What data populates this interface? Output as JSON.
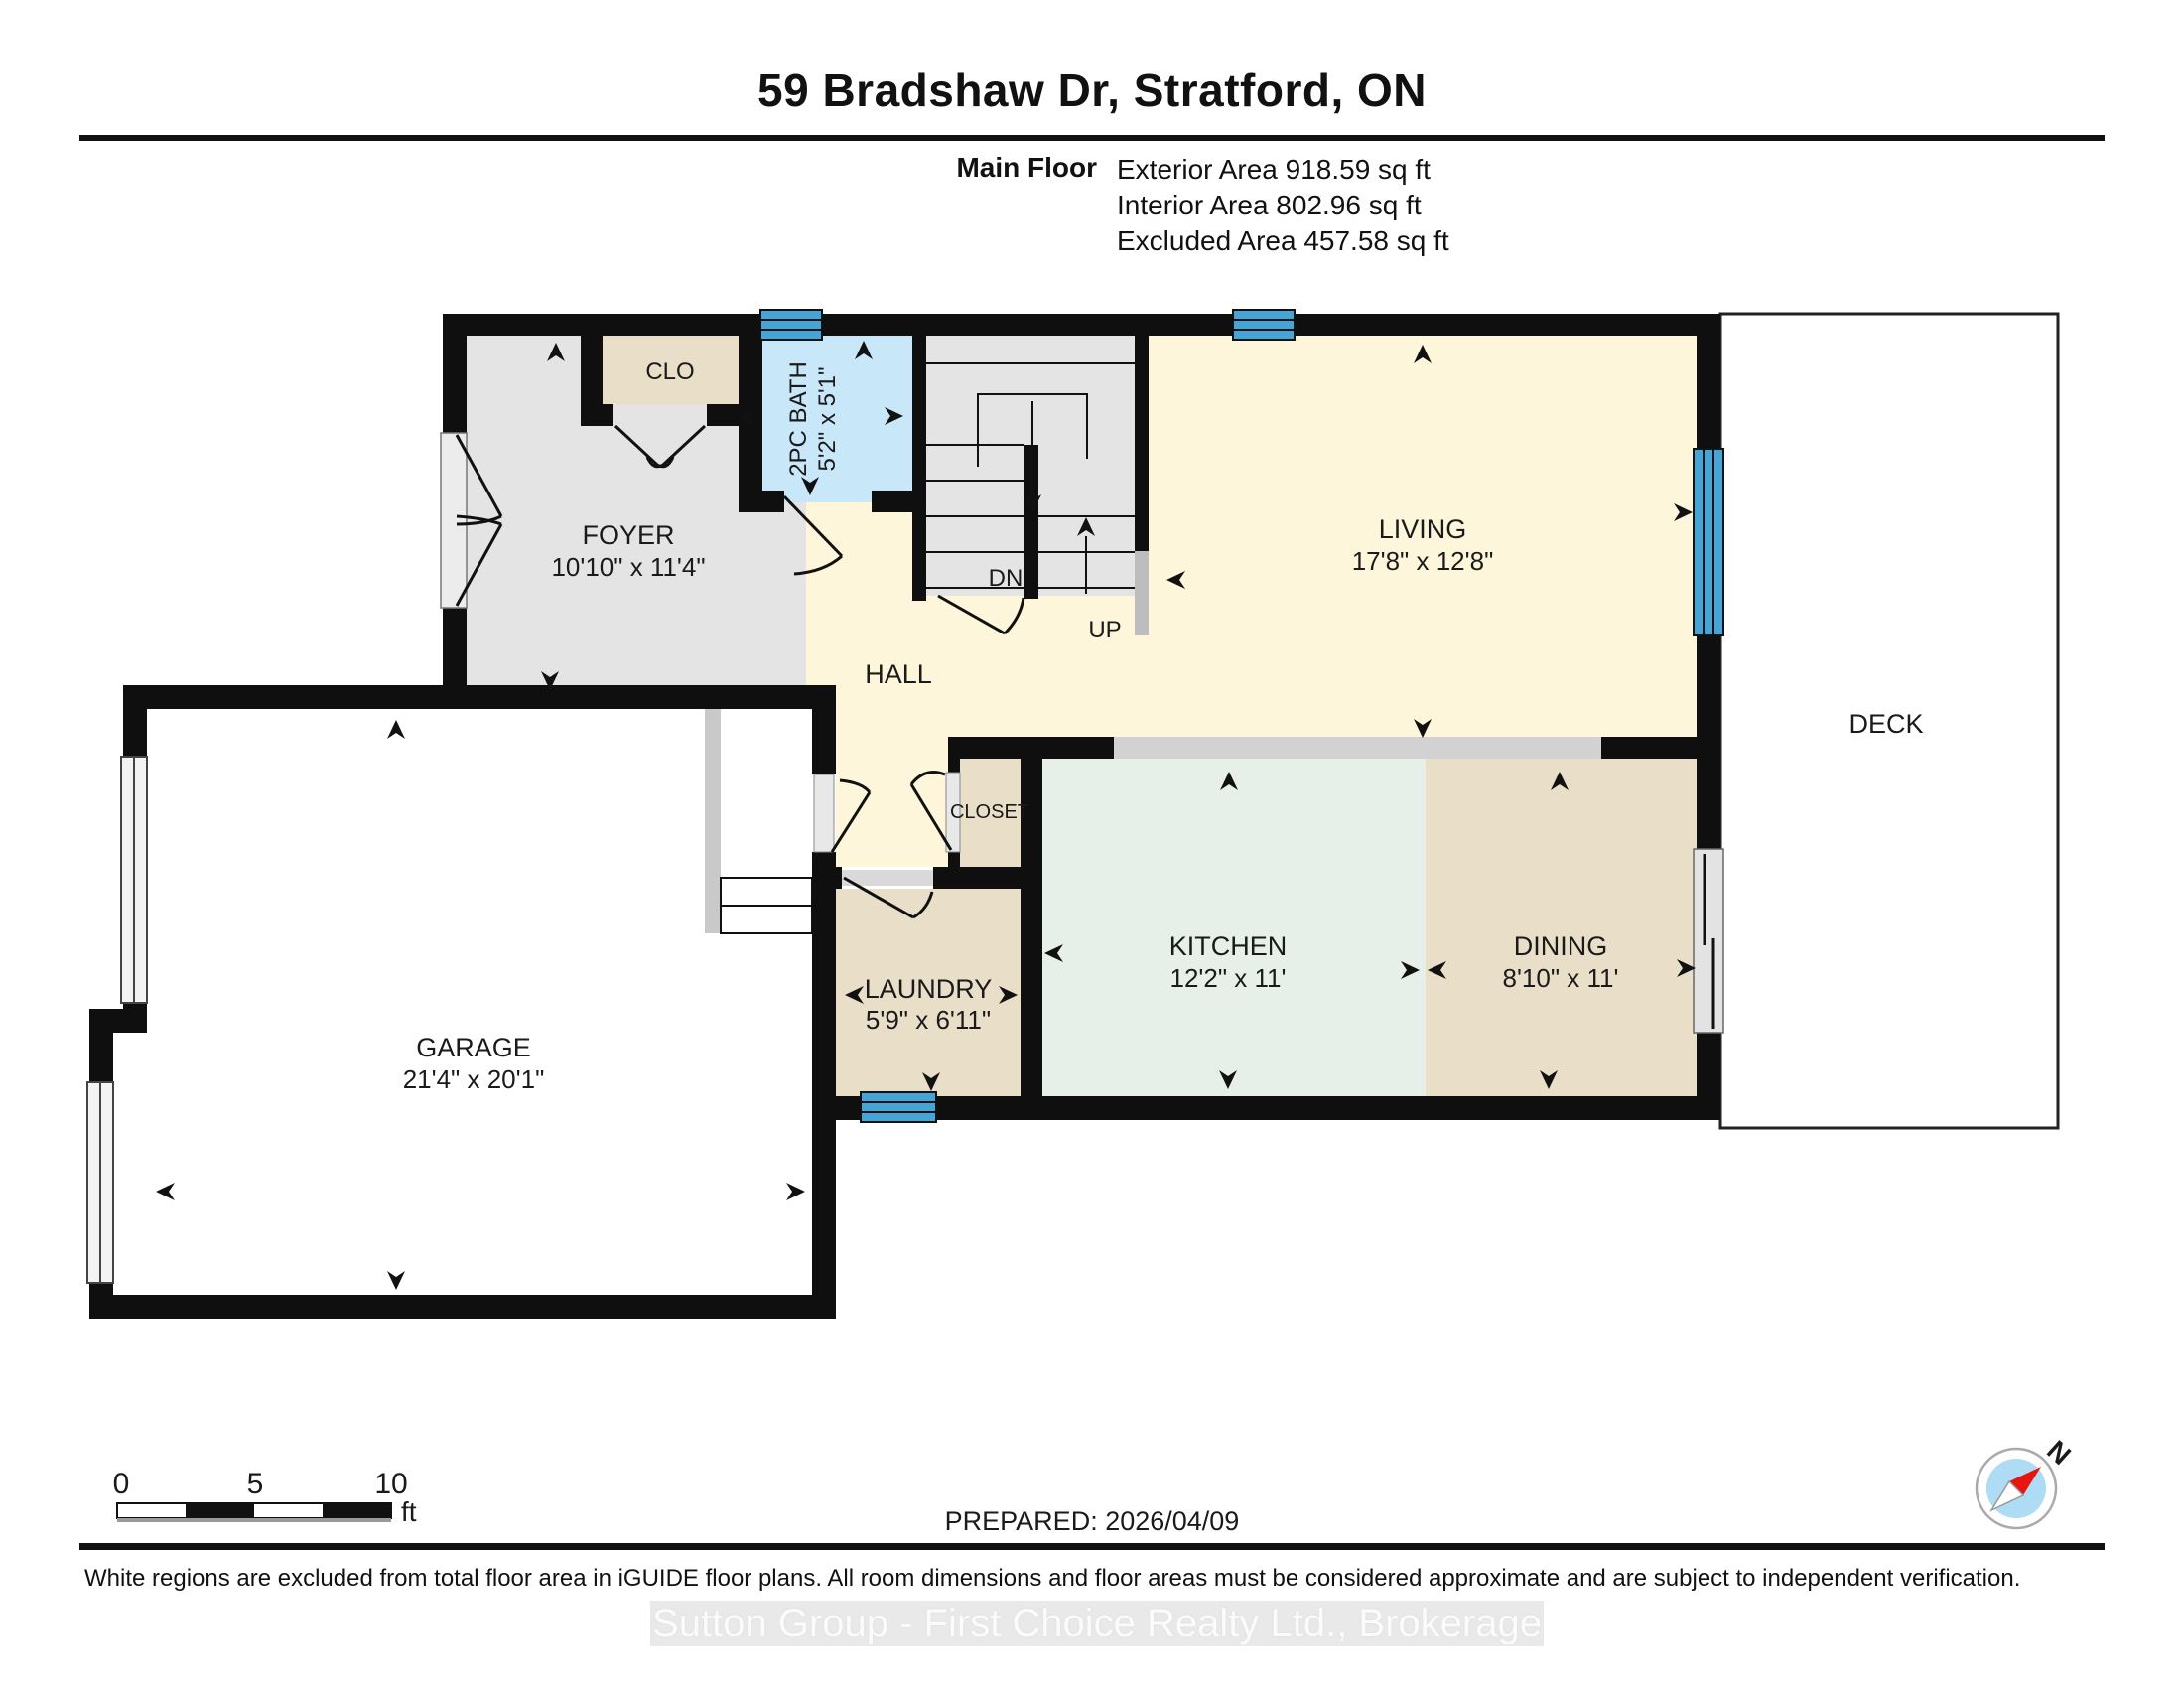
{
  "header": {
    "title": "59 Bradshaw Dr, Stratford, ON",
    "floor_label": "Main Floor",
    "area_lines": [
      "Exterior Area 918.59 sq ft",
      "Interior Area 802.96 sq ft",
      "Excluded Area 457.58 sq ft"
    ]
  },
  "rooms": {
    "foyer": {
      "name": "FOYER",
      "dims": "10'10\" x 11'4\""
    },
    "clo": {
      "name": "CLO"
    },
    "bath": {
      "name": "2PC BATH",
      "dims": "5'2\" x 5'1\""
    },
    "living": {
      "name": "LIVING",
      "dims": "17'8\" x 12'8\""
    },
    "hall": {
      "name": "HALL"
    },
    "deck": {
      "name": "DECK"
    },
    "closet": {
      "name": "CLOSET"
    },
    "kitchen": {
      "name": "KITCHEN",
      "dims": "12'2\" x 11'"
    },
    "dining": {
      "name": "DINING",
      "dims": "8'10\" x 11'"
    },
    "laundry": {
      "name": "LAUNDRY",
      "dims": "5'9\" x 6'11\""
    },
    "garage": {
      "name": "GARAGE",
      "dims": "21'4\" x 20'1\""
    },
    "stairs": {
      "up": "UP",
      "dn": "DN"
    }
  },
  "scale_bar": {
    "ticks": [
      "0",
      "5",
      "10"
    ],
    "unit": "ft"
  },
  "prepared_label": "PREPARED: 2026/04/09",
  "compass": {
    "north_label": "N"
  },
  "footer": {
    "disclaimer": "White regions are excluded from total floor area in iGUIDE floor plans. All room dimensions and floor areas must be considered approximate and are subject to independent verification.",
    "watermark": "Sutton Group - First Choice Realty Ltd., Brokerage"
  },
  "colors": {
    "wall": "#0f0f0f",
    "window_blue": "#44a5d6",
    "bath_blue": "#c8e7f9",
    "kitchen_mint": "#e7f0e8",
    "living_cream": "#fdf6da",
    "tan": "#e9dfc9",
    "gray_room": "#e4e4e4",
    "counter_gray": "#d2d2d2"
  }
}
